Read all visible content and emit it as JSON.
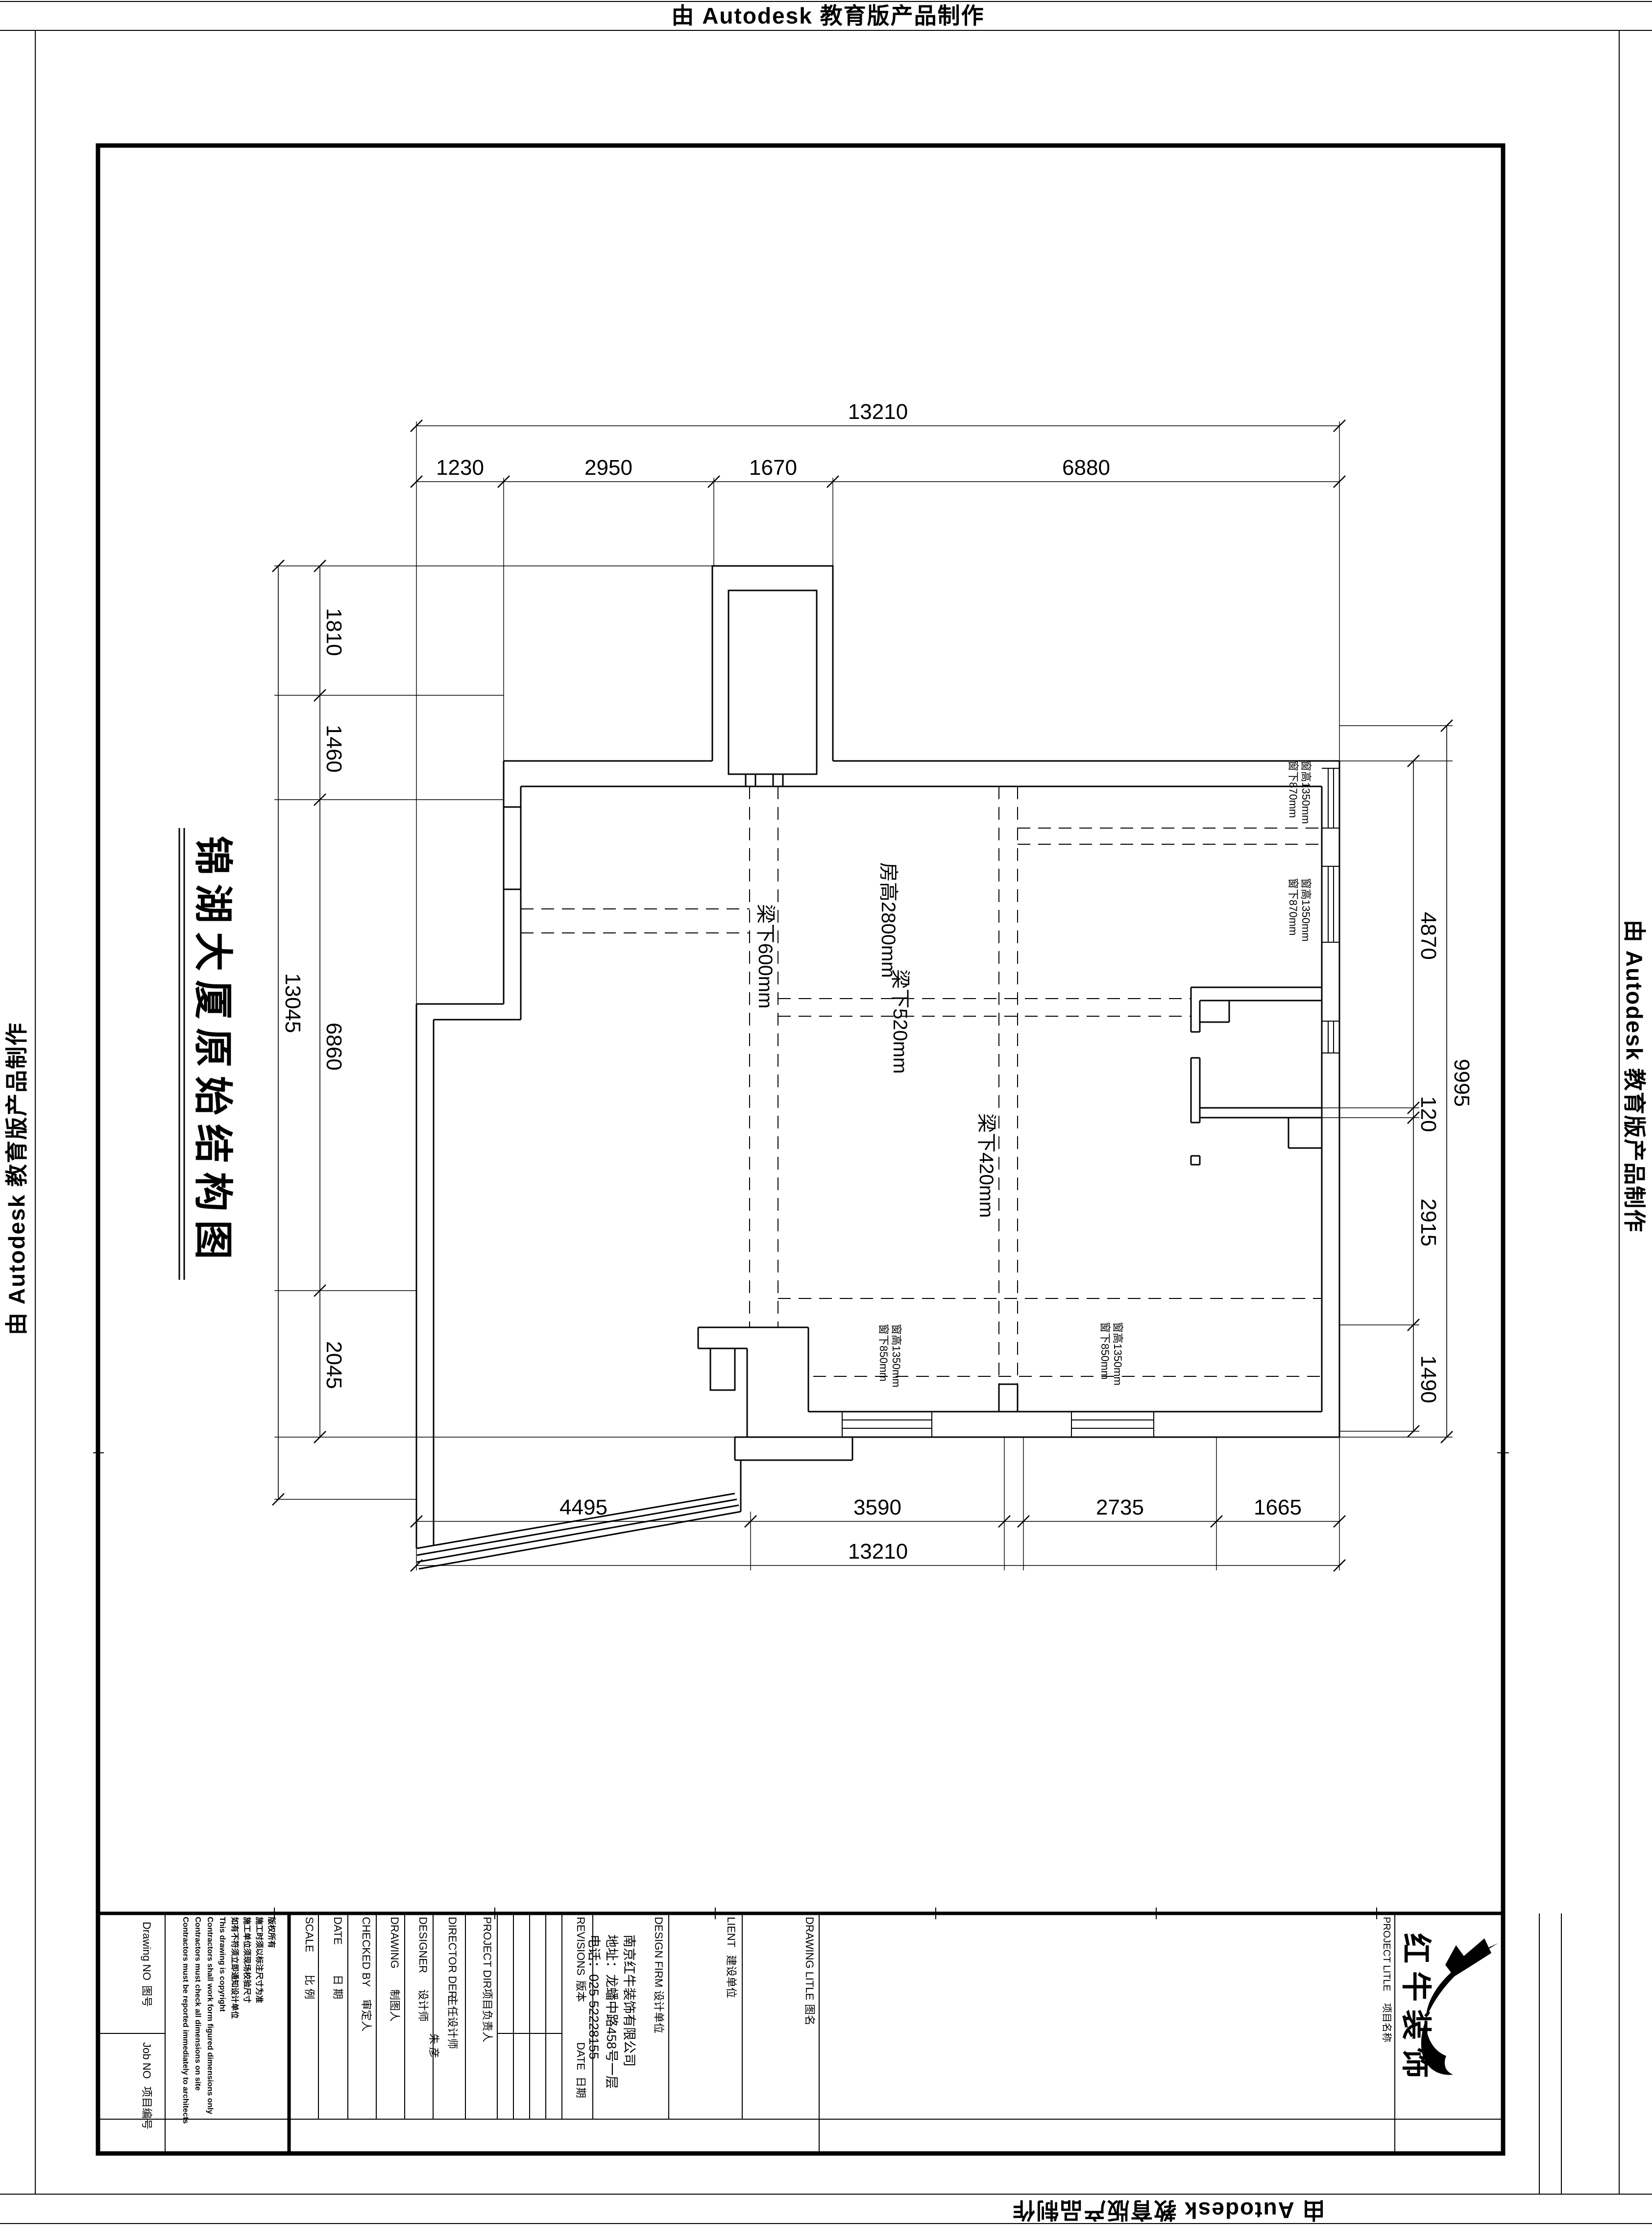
{
  "banner": {
    "text": "由 Autodesk 教育版产品制作"
  },
  "drawing_title": "锦湖大厦原始结构图",
  "plan": {
    "labels": {
      "room_height": "房高2800mm",
      "beam600": "梁下600mm",
      "beam520": "梁下520mm",
      "beam420": "梁下420mm"
    },
    "window_labels": {
      "right_upper": [
        "窗高1350mm",
        "窗下870mm"
      ],
      "right_lower": [
        "窗高1350mm",
        "窗下870mm"
      ],
      "bottom_left": [
        "窗高1350mm",
        "窗下850mm"
      ],
      "bottom_right": [
        "窗高1350mm",
        "窗下850mm"
      ]
    },
    "dimensions": {
      "top": {
        "total": "13210",
        "segments": [
          "1230",
          "2950",
          "1670",
          "6880"
        ]
      },
      "bottom": {
        "total": "13210",
        "segments": [
          "4495",
          "3590",
          "2735",
          "1665"
        ]
      },
      "left": {
        "total": "13045",
        "segments": [
          "1810",
          "1460",
          "6860",
          "2045"
        ]
      },
      "right": {
        "total": "9995",
        "segments": [
          "4870",
          "120",
          "2915",
          "1490"
        ]
      }
    }
  },
  "title_block": {
    "drawing_no_en": "Drawing NO",
    "drawing_no_cn": "图号",
    "job_no_en": "Job NO",
    "job_no_cn": "项目编号",
    "notes": [
      "版权所有",
      "施工时须以标注尺寸为准",
      "施工单位须现场校验尺寸",
      "如有不符须立即通知设计单位",
      "This drawing is copyright",
      "Contractors shall work form figured dimensions only",
      "Contractors must check all dimensions on site",
      "Contractors must be reported immediately to architects"
    ],
    "scale_en": "SCALE",
    "scale_cn": "比 例",
    "date_en": "DATE",
    "date_cn": "日 期",
    "checked_en": "CHECKED BY",
    "checked_cn": "审定人",
    "drawing_en": "DRAWING",
    "drawing_cn": "制图人",
    "designer_en": "DESIGNER",
    "designer_cn": "设计师",
    "director_en": "DIRECTOR DER",
    "director_cn": "主任设计师",
    "director_value": "朱 彦",
    "project_dir_en": "PROJECT DIR",
    "project_dir_cn": "项目负责人",
    "revisions_en": "REVISIONS",
    "revisions_cn": "版本",
    "rev_date_en": "DATE",
    "rev_date_cn": "日期",
    "design_firm_en": "DESIGN FIRM",
    "design_firm_cn": "设计单位",
    "firm_lines": [
      "南京红牛装饰有限公司",
      "地址：龙蟠中路458号一层",
      "电话：025-52228155"
    ],
    "client_en": "LIENT",
    "client_cn": "建设单位",
    "drawing_title_en": "DRAWING LITLE",
    "drawing_title_cn": "图名",
    "project_title_en": "PROJECT LITLE",
    "project_title_cn": "项目名称",
    "brand": "红牛装饰"
  }
}
